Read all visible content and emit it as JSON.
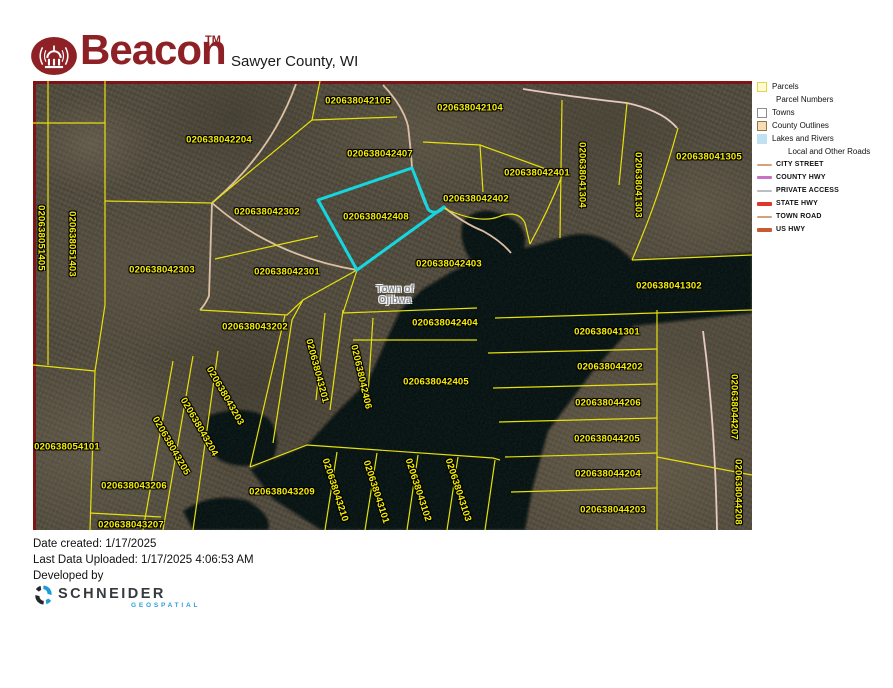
{
  "header": {
    "brand": "Beacon",
    "trademark": "TM",
    "title": "Sawyer County, WI",
    "brand_color": "#8e2125"
  },
  "map": {
    "town_label": {
      "line1": "Town of",
      "line2": "Ojibwa"
    },
    "highlighted_parcel": "020638042408",
    "highlight_color": "#15d7e0",
    "parcel_line_color": "#e6e00c",
    "parcel_label_color": "#f8ef04",
    "county_outline_color": "#7d1416",
    "road_color": "#dcc0a4",
    "water_color": "#06090d",
    "parcel_labels": [
      {
        "text": "020638042105",
        "x": 325,
        "y": 20,
        "r": 0
      },
      {
        "text": "020638042104",
        "x": 437,
        "y": 27,
        "r": 0
      },
      {
        "text": "020638042204",
        "x": 186,
        "y": 59,
        "r": 0
      },
      {
        "text": "020638042407",
        "x": 347,
        "y": 73,
        "r": 0
      },
      {
        "text": "020638042401",
        "x": 504,
        "y": 92,
        "r": 0
      },
      {
        "text": "020638041305",
        "x": 676,
        "y": 76,
        "r": 0
      },
      {
        "text": "020638041304",
        "x": 549,
        "y": 94,
        "r": 90
      },
      {
        "text": "020638041303",
        "x": 605,
        "y": 104,
        "r": 90
      },
      {
        "text": "020638051405",
        "x": 8,
        "y": 157,
        "r": 90
      },
      {
        "text": "020638051403",
        "x": 39,
        "y": 163,
        "r": 90
      },
      {
        "text": "020638042302",
        "x": 234,
        "y": 131,
        "r": 0
      },
      {
        "text": "020638042402",
        "x": 443,
        "y": 118,
        "r": 0
      },
      {
        "text": "020638042408",
        "x": 343,
        "y": 136,
        "r": 0
      },
      {
        "text": "020638042303",
        "x": 129,
        "y": 189,
        "r": 0
      },
      {
        "text": "020638042301",
        "x": 254,
        "y": 191,
        "r": 0
      },
      {
        "text": "020638042403",
        "x": 416,
        "y": 183,
        "r": 0
      },
      {
        "text": "020638041302",
        "x": 636,
        "y": 205,
        "r": 0
      },
      {
        "text": "020638042404",
        "x": 412,
        "y": 242,
        "r": 0
      },
      {
        "text": "020638043202",
        "x": 222,
        "y": 246,
        "r": 0
      },
      {
        "text": "020638041301",
        "x": 574,
        "y": 251,
        "r": 0
      },
      {
        "text": "020638042405",
        "x": 403,
        "y": 301,
        "r": 0
      },
      {
        "text": "020638044202",
        "x": 577,
        "y": 286,
        "r": 0
      },
      {
        "text": "020638044206",
        "x": 575,
        "y": 322,
        "r": 0
      },
      {
        "text": "020638044205",
        "x": 574,
        "y": 358,
        "r": 0
      },
      {
        "text": "020638044204",
        "x": 575,
        "y": 393,
        "r": 0
      },
      {
        "text": "020638044203",
        "x": 580,
        "y": 429,
        "r": 0
      },
      {
        "text": "020638054101",
        "x": 34,
        "y": 366,
        "r": 0
      },
      {
        "text": "020638043206",
        "x": 101,
        "y": 405,
        "r": 0
      },
      {
        "text": "020638043207",
        "x": 98,
        "y": 444,
        "r": 0
      },
      {
        "text": "020638043209",
        "x": 249,
        "y": 411,
        "r": 0
      },
      {
        "text": "020638043201",
        "x": 284,
        "y": 290,
        "r": 75
      },
      {
        "text": "020638042406",
        "x": 328,
        "y": 296,
        "r": 77
      },
      {
        "text": "020638043203",
        "x": 192,
        "y": 315,
        "r": 60
      },
      {
        "text": "020638043204",
        "x": 166,
        "y": 346,
        "r": 60
      },
      {
        "text": "020638043205",
        "x": 138,
        "y": 365,
        "r": 60
      },
      {
        "text": "020638043210",
        "x": 302,
        "y": 409,
        "r": 72
      },
      {
        "text": "020638043101",
        "x": 343,
        "y": 411,
        "r": 72
      },
      {
        "text": "020638043102",
        "x": 385,
        "y": 409,
        "r": 72
      },
      {
        "text": "020638043103",
        "x": 425,
        "y": 409,
        "r": 72
      },
      {
        "text": "020638044207",
        "x": 701,
        "y": 326,
        "r": 90
      },
      {
        "text": "020638044208",
        "x": 705,
        "y": 411,
        "r": 90
      }
    ]
  },
  "legend": {
    "items": [
      {
        "label": "Parcels",
        "swatch": "box",
        "fill": "#fffbd0",
        "border": "#e3d44a"
      },
      {
        "label": "Parcel Numbers",
        "swatch": "none"
      },
      {
        "label": "Towns",
        "swatch": "box",
        "fill": "#ffffff",
        "border": "#8d8d8d"
      },
      {
        "label": "County Outlines",
        "swatch": "box",
        "fill": "#f7ddb1",
        "border": "#8a7a50"
      },
      {
        "label": "Lakes and Rivers",
        "swatch": "box",
        "fill": "#bfe1f1",
        "border": "#bfe1f1"
      },
      {
        "label": "Local and Other Roads",
        "swatch": "indent"
      },
      {
        "label": "CITY STREET",
        "swatch": "line",
        "color": "#d2a27c",
        "weight": 2
      },
      {
        "label": "COUNTY HWY",
        "swatch": "line",
        "color": "#c673c6",
        "weight": 3
      },
      {
        "label": "PRIVATE ACCESS",
        "swatch": "line",
        "color": "#bdbdbd",
        "weight": 2
      },
      {
        "label": "STATE HWY",
        "swatch": "line",
        "color": "#e0372b",
        "weight": 4
      },
      {
        "label": "TOWN ROAD",
        "swatch": "line",
        "color": "#d2a27c",
        "weight": 2
      },
      {
        "label": "US HWY",
        "swatch": "line",
        "color": "#c95a33",
        "weight": 4
      }
    ]
  },
  "footer": {
    "date_created": "Date created: 1/17/2025",
    "last_uploaded": "Last Data Uploaded: 1/17/2025 4:06:53 AM",
    "developed_by": "Developed by",
    "brand": "SCHNEIDER",
    "brand_sub": "GEOSPATIAL"
  }
}
